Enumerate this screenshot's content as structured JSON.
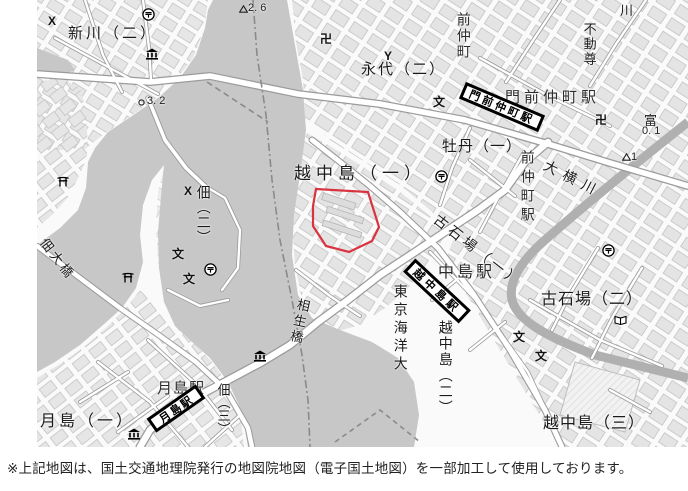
{
  "caption": {
    "text": "※上記地図は、国土交通地理院発行の地図院地図（電子国土地図）を一部加工して使用しております。"
  },
  "map": {
    "highlight_color": "#d9333f",
    "water_name": "隅田川・大横川",
    "banners": [
      {
        "name": "station-banner-monzennakacho",
        "text": "門前仲町駅",
        "x": 502,
        "y": 107,
        "w": 86,
        "h": 18,
        "rot": 23,
        "fs": 11,
        "sp": 3
      },
      {
        "name": "station-banner-etchujima",
        "text": "越中島駅",
        "x": 437,
        "y": 291,
        "w": 76,
        "h": 18,
        "rot": 43,
        "fs": 11,
        "sp": 4
      },
      {
        "name": "station-banner-tsukishima",
        "text": "月島駅",
        "x": 176,
        "y": 408,
        "w": 60,
        "h": 17,
        "rot": -35,
        "fs": 11,
        "sp": 2
      }
    ],
    "labels": [
      {
        "name": "district-shinkawa2",
        "text": "新川（二）",
        "x": 68,
        "y": 26,
        "size": 15,
        "sp": 3
      },
      {
        "name": "district-eitai2",
        "text": "永代（二）",
        "x": 361,
        "y": 62,
        "size": 15,
        "sp": 2
      },
      {
        "name": "district-botan1",
        "text": "牡丹（一）",
        "x": 442,
        "y": 139,
        "size": 15,
        "sp": 1
      },
      {
        "name": "district-etchujima1",
        "text": "越中島（一）",
        "x": 294,
        "y": 165,
        "size": 17,
        "sp": 5
      },
      {
        "name": "district-koishikawa1",
        "text": "古石場（一）",
        "x": 440,
        "y": 212,
        "size": 14,
        "sp": 4,
        "rot": 38
      },
      {
        "name": "district-koishikawa2",
        "text": "古石場（二）",
        "x": 541,
        "y": 292,
        "size": 16,
        "sp": 1
      },
      {
        "name": "district-etchujima3",
        "text": "越中島（三）",
        "x": 543,
        "y": 416,
        "size": 16,
        "sp": 1
      },
      {
        "name": "district-tsukishima1",
        "text": "月島（一）",
        "x": 40,
        "y": 414,
        "size": 16,
        "sp": 3
      },
      {
        "name": "district-tsukuda2",
        "text": "佃（二）",
        "x": 196,
        "y": 185,
        "size": 14,
        "sp": 1,
        "vertical": true
      },
      {
        "name": "district-tsukuda3",
        "text": "佃（三）",
        "x": 216,
        "y": 383,
        "size": 13,
        "sp": 0,
        "vertical": true
      },
      {
        "name": "district-etchujima2",
        "text": "越中島（二）",
        "x": 438,
        "y": 320,
        "size": 14,
        "sp": 2,
        "vertical": true
      },
      {
        "name": "poi-kaiyodai",
        "text": "東京海洋大",
        "x": 393,
        "y": 284,
        "size": 14,
        "sp": 4,
        "vertical": true
      },
      {
        "name": "river-oyokogawa",
        "text": "大横川",
        "x": 548,
        "y": 158,
        "size": 14,
        "sp": 7,
        "rot": 27
      },
      {
        "name": "bridge-aioibashi",
        "text": "相生橋",
        "x": 297,
        "y": 297,
        "size": 13,
        "sp": 3,
        "vertical": true,
        "rot": 12
      },
      {
        "name": "bridge-tsukudaohashi",
        "text": "佃大橋",
        "x": 48,
        "y": 236,
        "size": 13,
        "sp": 3,
        "rot": 52
      },
      {
        "name": "poi-fudoson",
        "text": "不動尊",
        "x": 582,
        "y": 22,
        "size": 13,
        "sp": 2,
        "vertical": true
      },
      {
        "name": "river-kawa-fragment",
        "text": "川",
        "x": 620,
        "y": 4,
        "size": 13,
        "sp": 0
      },
      {
        "name": "label-tomi-fragment",
        "text": "富",
        "x": 644,
        "y": 114,
        "size": 13,
        "sp": 0
      },
      {
        "name": "station-monzennakacho-text",
        "text": "門前仲町駅",
        "x": 505,
        "y": 90,
        "size": 15,
        "sp": 4,
        "color": "#2b2b2b"
      },
      {
        "name": "station-monzennakacho-vert",
        "text": "前仲町",
        "x": 456,
        "y": 12,
        "size": 14,
        "sp": 2,
        "vertical": true,
        "color": "#2b2b2b"
      },
      {
        "name": "station-monzennakacho-vert2",
        "text": "前仲町駅",
        "x": 520,
        "y": 150,
        "size": 14,
        "sp": 5,
        "vertical": true,
        "color": "#2b2b2b"
      },
      {
        "name": "station-etchujima-text",
        "text": "中島駅",
        "x": 438,
        "y": 265,
        "size": 16,
        "sp": 3,
        "color": "#2b2b2b"
      },
      {
        "name": "station-tsukishima-text",
        "text": "月島駅",
        "x": 157,
        "y": 381,
        "size": 15,
        "sp": 1,
        "color": "#2b2b2b"
      },
      {
        "name": "elev-3-2",
        "text": "3. 2",
        "x": 147,
        "y": 96,
        "size": 11,
        "sp": 0,
        "color": "#222"
      },
      {
        "name": "elev-2-6",
        "text": "2. 6",
        "x": 248,
        "y": 3,
        "size": 11,
        "sp": 0,
        "color": "#222"
      },
      {
        "name": "elev-0-1",
        "text": "0. 1",
        "x": 642,
        "y": 126,
        "size": 11,
        "sp": 0,
        "color": "#222"
      },
      {
        "name": "elev-1",
        "text": "1",
        "x": 631,
        "y": 152,
        "size": 11,
        "sp": 0,
        "color": "#222"
      }
    ],
    "symbols": [
      {
        "type": "post-office",
        "x": 142,
        "y": 8
      },
      {
        "type": "post-office",
        "x": 435,
        "y": 170
      },
      {
        "type": "post-office",
        "x": 204,
        "y": 263
      },
      {
        "type": "post-office",
        "x": 602,
        "y": 244
      },
      {
        "type": "museum",
        "x": 145,
        "y": 48
      },
      {
        "type": "museum",
        "x": 253,
        "y": 350
      },
      {
        "type": "museum",
        "x": 127,
        "y": 428
      },
      {
        "type": "police",
        "x": 48,
        "y": 15
      },
      {
        "type": "police",
        "x": 184,
        "y": 185
      },
      {
        "type": "temple",
        "x": 320,
        "y": 33
      },
      {
        "type": "temple",
        "x": 595,
        "y": 114
      },
      {
        "type": "fire",
        "x": 384,
        "y": 50
      },
      {
        "type": "school",
        "x": 172,
        "y": 248
      },
      {
        "type": "school",
        "x": 183,
        "y": 273
      },
      {
        "type": "school",
        "x": 433,
        "y": 96
      },
      {
        "type": "school",
        "x": 513,
        "y": 331
      },
      {
        "type": "school",
        "x": 535,
        "y": 350
      },
      {
        "type": "torii",
        "x": 57,
        "y": 176
      },
      {
        "type": "torii",
        "x": 122,
        "y": 272
      },
      {
        "type": "library",
        "x": 614,
        "y": 315
      },
      {
        "type": "elev-circle",
        "x": 138,
        "y": 99
      },
      {
        "type": "elev-triangle",
        "x": 239,
        "y": 5
      },
      {
        "type": "elev-triangle",
        "x": 622,
        "y": 153
      }
    ]
  }
}
